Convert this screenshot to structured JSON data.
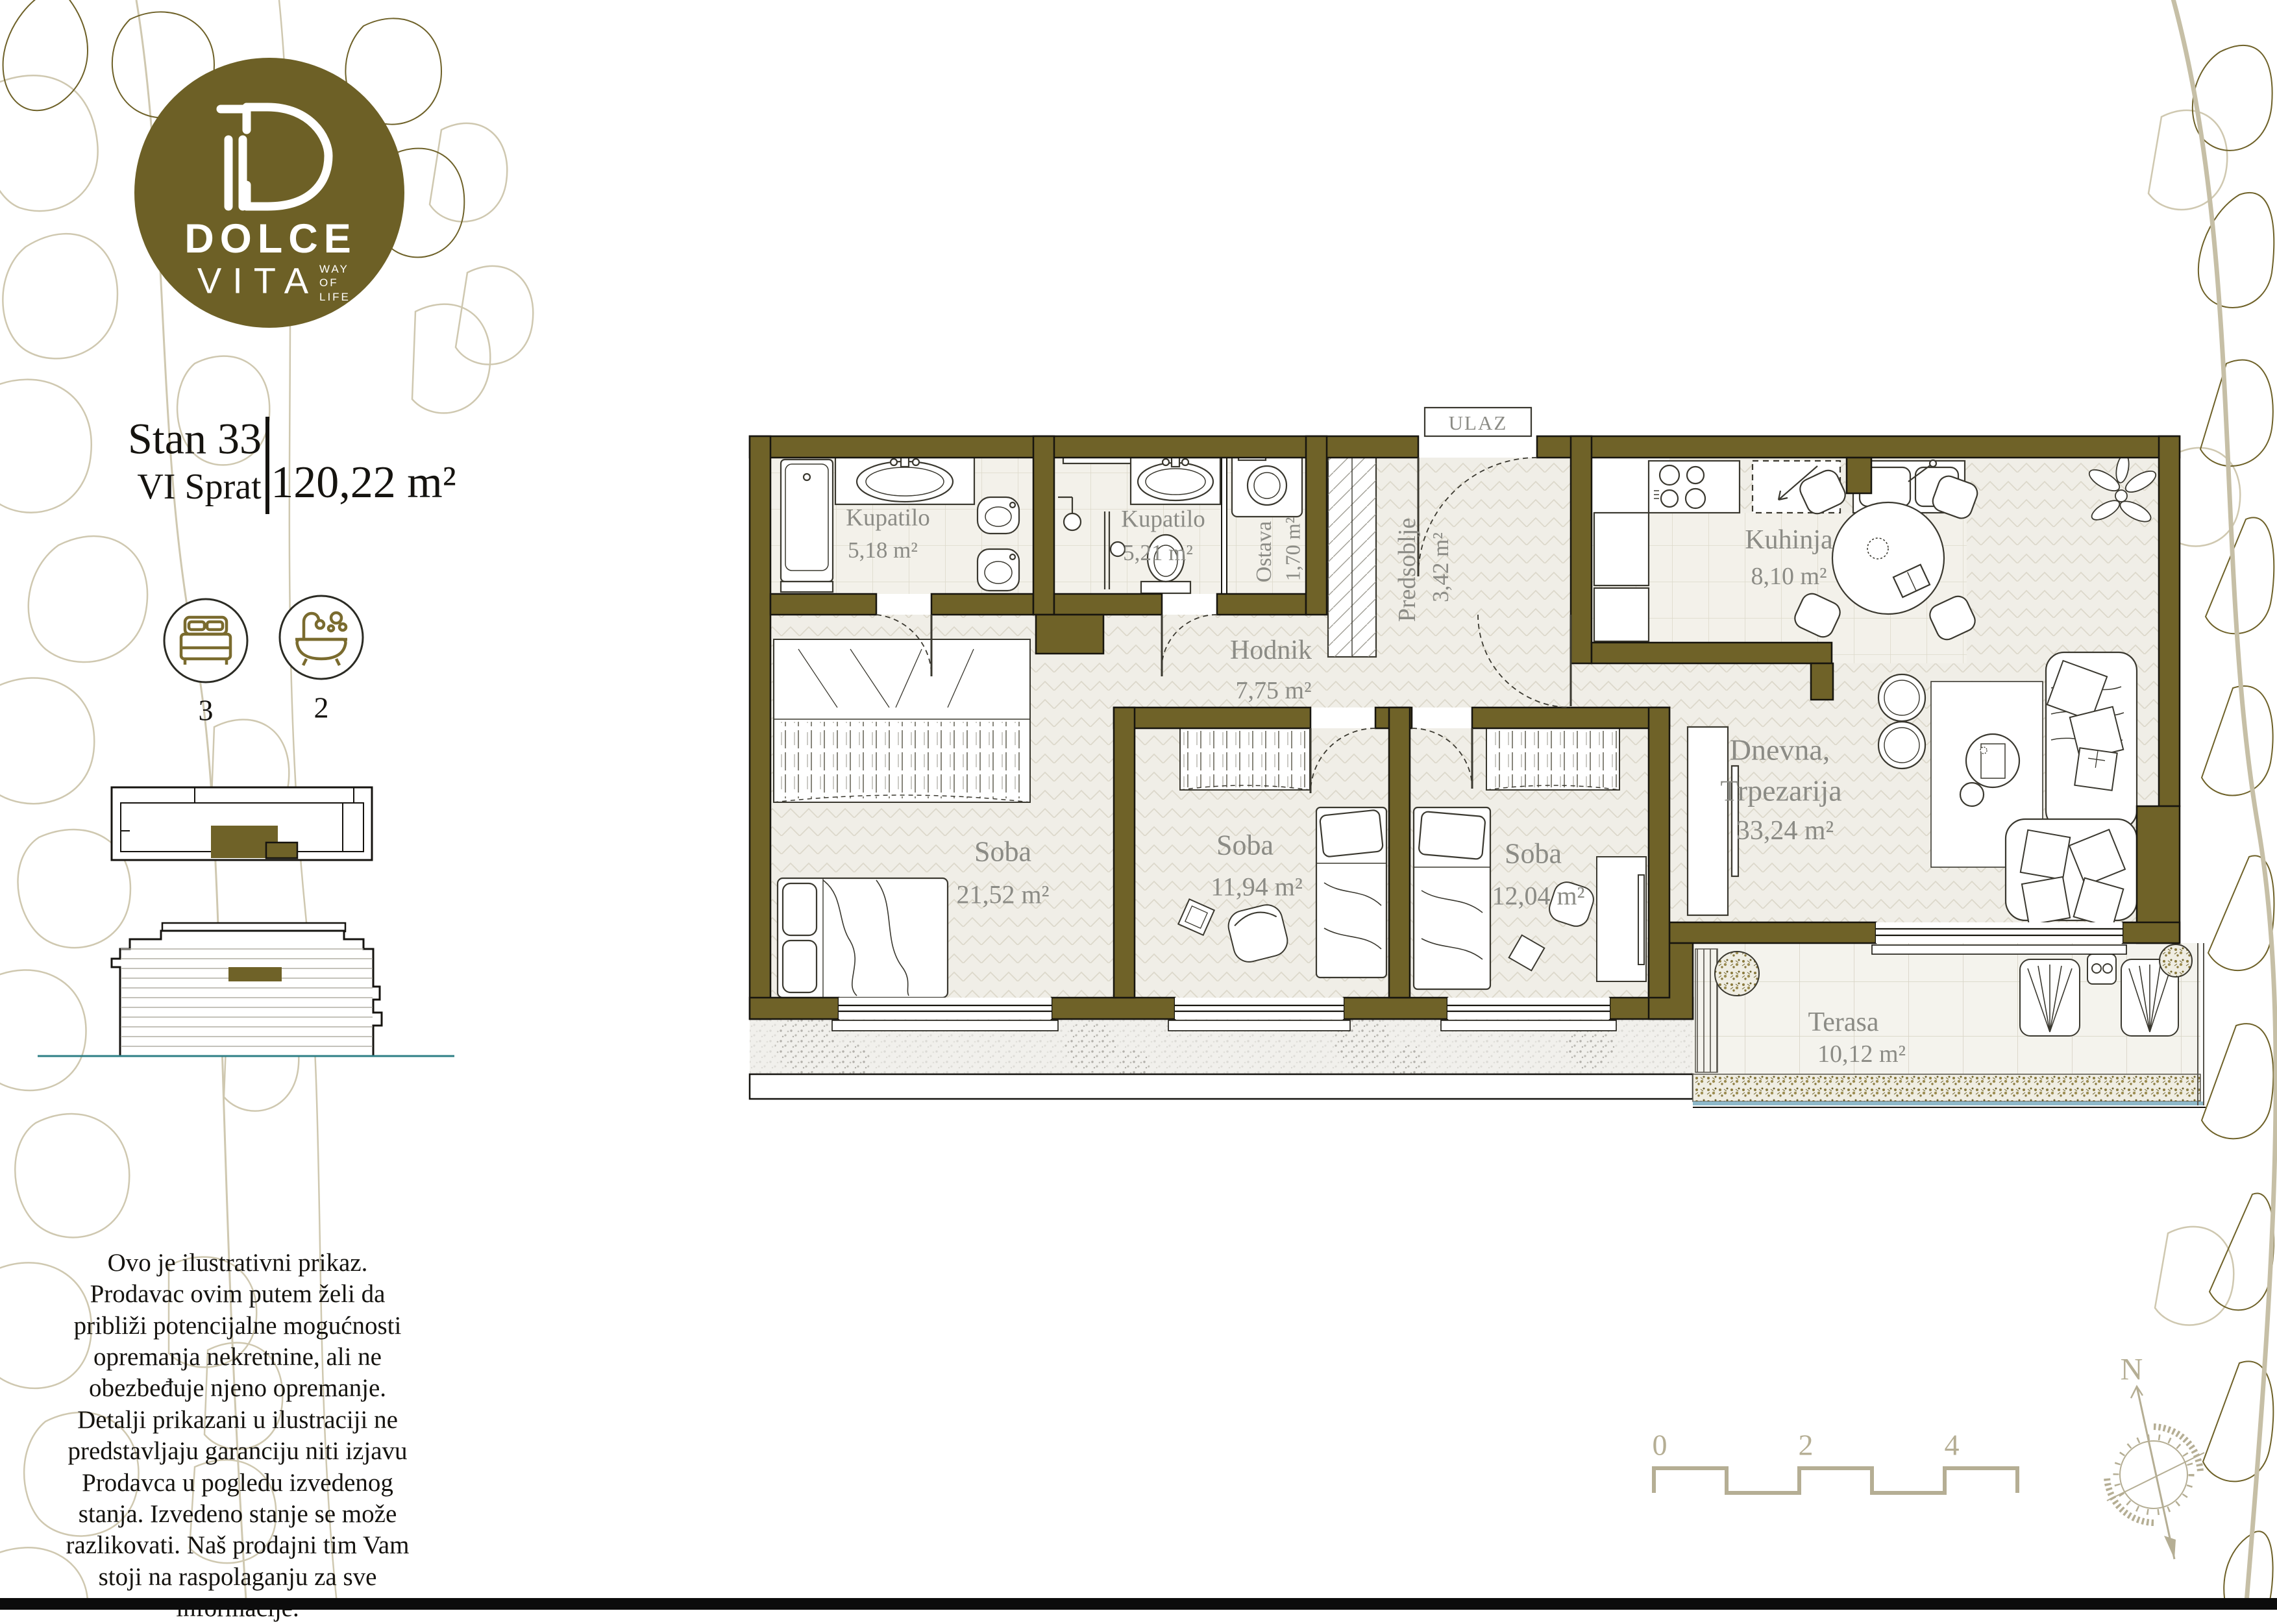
{
  "brand": {
    "monogram": "D",
    "name_line1": "DOLCE",
    "name_line2": "VITA",
    "tagline_line1": "WAY",
    "tagline_line2": "OF",
    "tagline_line3": "LIFE"
  },
  "unit": {
    "title": "Stan 33",
    "floor": "VI Sprat",
    "area": "120,22 m²",
    "bedrooms_count": "3",
    "bathrooms_count": "2"
  },
  "plan": {
    "entrance_label": "ULAZ",
    "rooms": [
      {
        "name": "Kupatilo",
        "area": "5,18 m²"
      },
      {
        "name": "Kupatilo",
        "area": "5,21 m²"
      },
      {
        "name": "Ostava",
        "area": "1,70 m²"
      },
      {
        "name": "Predsoblje",
        "area": "3,42 m²"
      },
      {
        "name": "Kuhinja",
        "area": "8,10 m²"
      },
      {
        "name": "Hodnik",
        "area": "7,75 m²"
      },
      {
        "name": "Soba",
        "area": "21,52 m²"
      },
      {
        "name": "Soba",
        "area": "11,94 m²"
      },
      {
        "name": "Soba",
        "area": "12,04 m²"
      },
      {
        "name": "Dnevna,",
        "name2": "Trpezarija",
        "area": "33,24 m²"
      },
      {
        "name": "Terasa",
        "area": "10,12 m²"
      }
    ]
  },
  "scale_bar": {
    "tick0": "0",
    "tick2": "2",
    "tick4": "4"
  },
  "compass": {
    "north": "N"
  },
  "disclaimer": "Ovo je ilustrativni prikaz. Prodavac ovim putem želi da približi potencijalne mogućnosti opremanja nekretnine, ali ne obezbeđuje njeno opremanje. Detalji prikazani u ilustraciji ne predstavljaju garanciju niti izjavu Prodavca u pogledu izvedenog stanja. Izvedeno stanje se može razlikovati. Naš prodajni tim Vam stoji na raspolaganju za sve informacije.",
  "colors": {
    "wall_olive": "#6f6228",
    "logo_olive": "#6d6026",
    "leaf_light": "#cfc8b0",
    "leaf_dark": "#6e6128",
    "label_gray": "#8b8b85",
    "scale_tan": "#b5ae94",
    "teal_ground": "#2e7f86",
    "planter_blue": "#8db8c9"
  }
}
